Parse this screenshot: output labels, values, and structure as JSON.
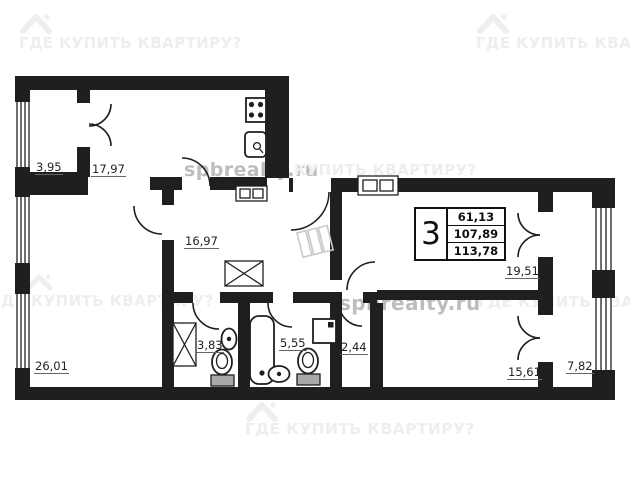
{
  "title": "Apartment floor plan",
  "colors": {
    "wall": "#1f1f1f",
    "label": "#222222",
    "underline": "#666666",
    "wm_light": "#eeeeee",
    "wm_gray": "#bdbdbd",
    "sketch": "#c9c9c9",
    "fixture_fill": "#a9a9a9"
  },
  "watermarks": {
    "brand": "ГДЕ КУПИТЬ КВАРТИРУ?",
    "brand_partial_mid": "КУПИТЬ КВАРТИРУ?",
    "site": "spbrealty.ru"
  },
  "info_table": {
    "room_count": "3",
    "living_area": "61,13",
    "total_area": "107,89",
    "total_area_with_balconies": "113,78"
  },
  "rooms": {
    "balcony_top_left": {
      "area": "3,95"
    },
    "kitchen": {
      "area": "17,97"
    },
    "hall": {
      "area": "16,97"
    },
    "living_room": {
      "area": "26,01"
    },
    "room_top_right": {
      "area": "19,51"
    },
    "wc": {
      "area": "3,83"
    },
    "bathroom": {
      "area": "5,55"
    },
    "storage": {
      "area": "2,44"
    },
    "bedroom_bottom_right": {
      "area": "15,61"
    },
    "balcony_right": {
      "area": "7,82"
    }
  }
}
